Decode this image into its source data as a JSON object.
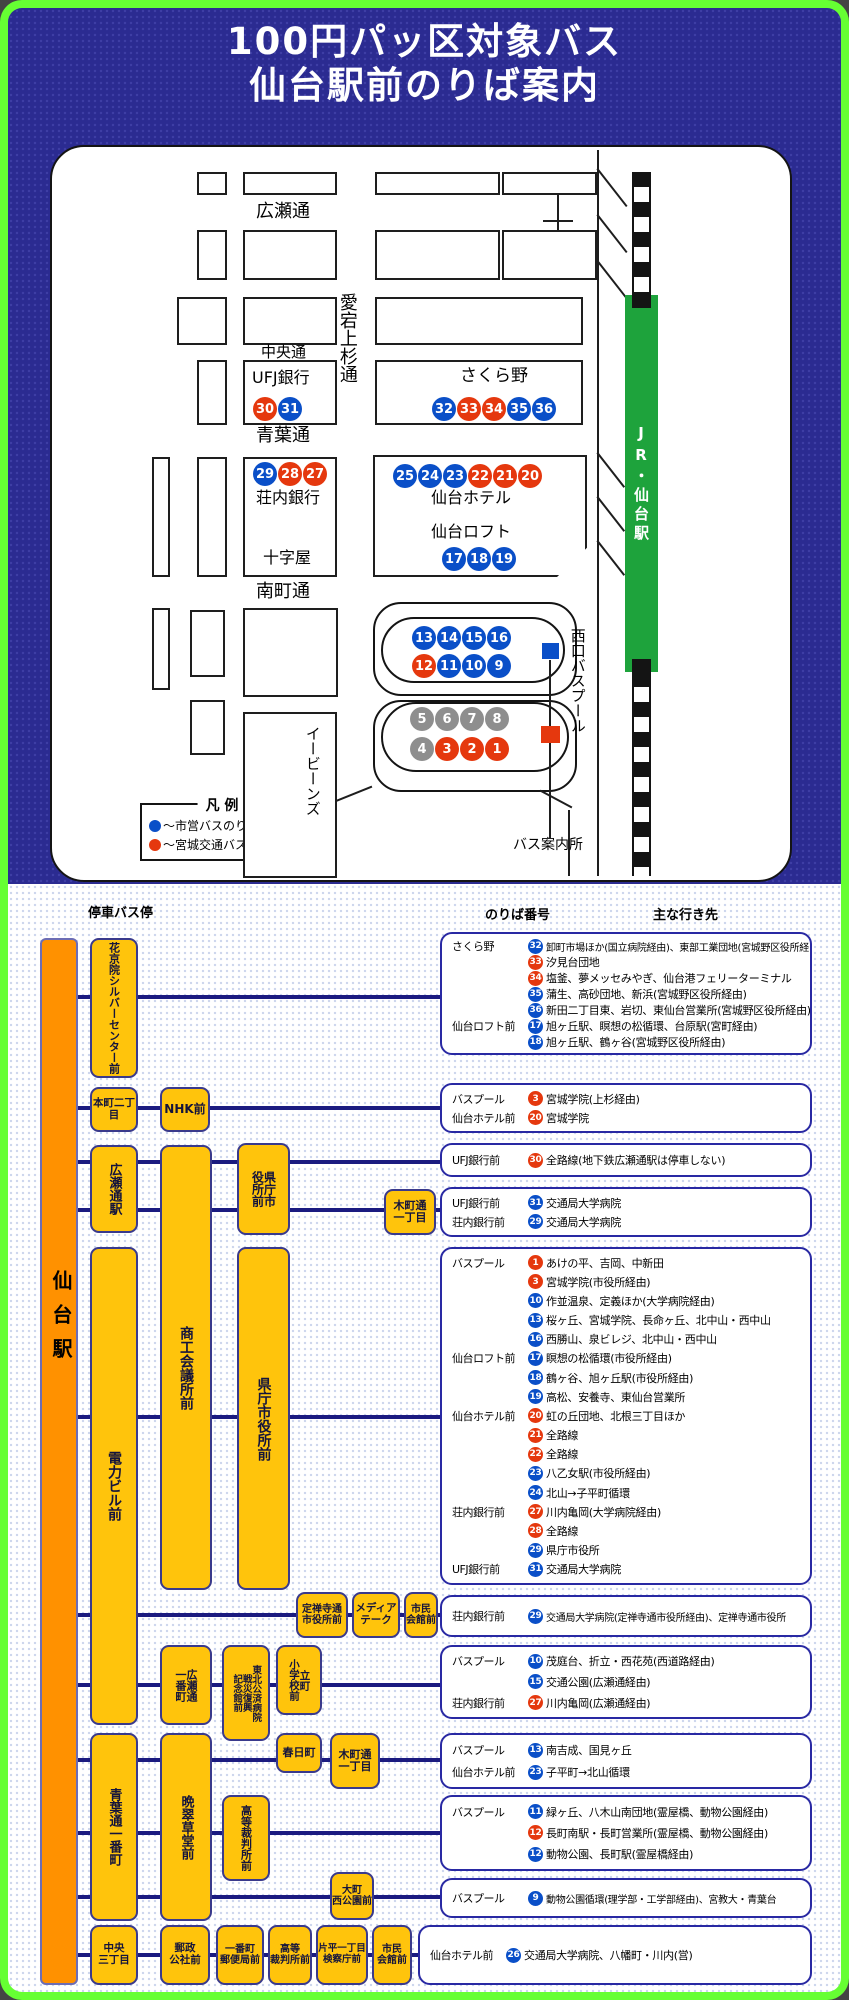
{
  "title": {
    "line1": "100円パッ区対象バス",
    "line2": "仙台駅前のりば案内"
  },
  "colors": {
    "municipal_blue": "#0a4fc8",
    "miyagi_kotsu_red": "#e5380e",
    "gray": "#8e8e8e",
    "line_navy": "#1b1b80",
    "stop_yellow": "#ffc40c",
    "station_orange": "#ff9100",
    "jr_green": "#1ea33c",
    "frame_green": "#66ff33"
  },
  "map": {
    "jr_label": "JR・仙台駅",
    "north_label": "N",
    "legend": {
      "title": "凡 例",
      "items": [
        {
          "c": "b",
          "t": "〜市営バスのりば"
        },
        {
          "c": "r",
          "t": "〜宮城交通バスのりば"
        }
      ]
    },
    "labels": [
      {
        "t": "広瀬通",
        "x": 256,
        "y": 203,
        "fs": 18
      },
      {
        "t": "中央通",
        "x": 261,
        "y": 345,
        "fs": 15
      },
      {
        "t": "青葉通",
        "x": 256,
        "y": 427,
        "fs": 18
      },
      {
        "t": "南町通",
        "x": 256,
        "y": 583,
        "fs": 18
      },
      {
        "t": "愛宕上杉通",
        "x": 337,
        "y": 293,
        "fs": 18,
        "v": 1
      },
      {
        "t": "西口バスプール",
        "x": 569,
        "y": 628,
        "fs": 15,
        "v": 1
      },
      {
        "t": "イービーンズ",
        "x": 304,
        "y": 726,
        "fs": 15,
        "v": 1
      },
      {
        "t": "バス案内所",
        "x": 513,
        "y": 838,
        "fs": 14
      },
      {
        "t": "UFJ銀行",
        "x": 252,
        "y": 370,
        "fs": 16
      },
      {
        "t": "さくら野",
        "x": 460,
        "y": 368,
        "fs": 17
      },
      {
        "t": "荘内銀行",
        "x": 256,
        "y": 490,
        "fs": 16
      },
      {
        "t": "十字屋",
        "x": 263,
        "y": 550,
        "fs": 16
      },
      {
        "t": "仙台ホテル",
        "x": 431,
        "y": 490,
        "fs": 16
      },
      {
        "t": "仙台ロフト",
        "x": 431,
        "y": 524,
        "fs": 16
      }
    ],
    "stands": [
      {
        "n": 30,
        "c": "r",
        "x": 253,
        "y": 397
      },
      {
        "n": 31,
        "c": "b",
        "x": 278,
        "y": 397
      },
      {
        "n": 32,
        "c": "b",
        "x": 432,
        "y": 397
      },
      {
        "n": 33,
        "c": "r",
        "x": 457,
        "y": 397
      },
      {
        "n": 34,
        "c": "r",
        "x": 482,
        "y": 397
      },
      {
        "n": 35,
        "c": "b",
        "x": 507,
        "y": 397
      },
      {
        "n": 36,
        "c": "b",
        "x": 532,
        "y": 397
      },
      {
        "n": 29,
        "c": "b",
        "x": 253,
        "y": 462
      },
      {
        "n": 28,
        "c": "r",
        "x": 278,
        "y": 462
      },
      {
        "n": 27,
        "c": "r",
        "x": 303,
        "y": 462
      },
      {
        "n": 25,
        "c": "b",
        "x": 393,
        "y": 464
      },
      {
        "n": 24,
        "c": "b",
        "x": 418,
        "y": 464
      },
      {
        "n": 23,
        "c": "b",
        "x": 443,
        "y": 464
      },
      {
        "n": 22,
        "c": "r",
        "x": 468,
        "y": 464
      },
      {
        "n": 21,
        "c": "r",
        "x": 493,
        "y": 464
      },
      {
        "n": 20,
        "c": "r",
        "x": 518,
        "y": 464
      },
      {
        "n": 17,
        "c": "b",
        "x": 442,
        "y": 547
      },
      {
        "n": 18,
        "c": "b",
        "x": 467,
        "y": 547
      },
      {
        "n": 19,
        "c": "b",
        "x": 492,
        "y": 547
      },
      {
        "n": 13,
        "c": "b",
        "x": 412,
        "y": 626
      },
      {
        "n": 14,
        "c": "b",
        "x": 437,
        "y": 626
      },
      {
        "n": 15,
        "c": "b",
        "x": 462,
        "y": 626
      },
      {
        "n": 16,
        "c": "b",
        "x": 487,
        "y": 626
      },
      {
        "n": 12,
        "c": "r",
        "x": 412,
        "y": 654
      },
      {
        "n": 11,
        "c": "b",
        "x": 437,
        "y": 654
      },
      {
        "n": 10,
        "c": "b",
        "x": 462,
        "y": 654
      },
      {
        "n": 9,
        "c": "b",
        "x": 487,
        "y": 654
      },
      {
        "n": 5,
        "c": "g",
        "x": 410,
        "y": 707
      },
      {
        "n": 6,
        "c": "g",
        "x": 435,
        "y": 707
      },
      {
        "n": 7,
        "c": "g",
        "x": 460,
        "y": 707
      },
      {
        "n": 8,
        "c": "g",
        "x": 485,
        "y": 707
      },
      {
        "n": 4,
        "c": "g",
        "x": 410,
        "y": 737
      },
      {
        "n": 3,
        "c": "r",
        "x": 435,
        "y": 737
      },
      {
        "n": 2,
        "c": "r",
        "x": 460,
        "y": 737
      },
      {
        "n": 1,
        "c": "r",
        "x": 485,
        "y": 737
      }
    ]
  },
  "diagram": {
    "headers": [
      "停車バス停",
      "のりば番号",
      "主な行き先"
    ],
    "station": "仙台駅",
    "stops": [
      {
        "label": "花京院シルバーセンター前",
        "x": 90,
        "y": 938,
        "w": 48,
        "h": 140,
        "mode": "v",
        "fs": 11
      },
      {
        "label": "本町二丁目",
        "x": 90,
        "y": 1087,
        "w": 48,
        "h": 45,
        "mode": "h",
        "fs": 10.5
      },
      {
        "label": "NHK前",
        "x": 160,
        "y": 1087,
        "w": 50,
        "h": 45,
        "mode": "h",
        "fs": 12
      },
      {
        "label": "広瀬通駅",
        "x": 90,
        "y": 1145,
        "w": 48,
        "h": 88,
        "mode": "v",
        "fs": 13
      },
      {
        "label": "商工会議所前",
        "x": 160,
        "y": 1145,
        "w": 52,
        "h": 445,
        "mode": "v",
        "fs": 14
      },
      {
        "label": "県庁市役所前",
        "x": 237,
        "y": 1143,
        "w": 53,
        "h": 92,
        "mode": "v",
        "lines": [
          "県庁市",
          "役所前"
        ],
        "fs": 12
      },
      {
        "label": "木町通一丁目",
        "x": 384,
        "y": 1189,
        "w": 52,
        "h": 46,
        "mode": "h",
        "lines": [
          "木町通",
          "一丁目"
        ],
        "fs": 11
      },
      {
        "label": "電力ビル前",
        "x": 90,
        "y": 1247,
        "w": 48,
        "h": 478,
        "mode": "v",
        "fs": 14
      },
      {
        "label": "県庁市役所前",
        "x": 237,
        "y": 1247,
        "w": 53,
        "h": 343,
        "mode": "v",
        "fs": 14
      },
      {
        "label": "定禅寺通市役所前",
        "x": 296,
        "y": 1592,
        "w": 52,
        "h": 46,
        "mode": "h",
        "lines": [
          "定禅寺通",
          "市役所前"
        ],
        "fs": 10
      },
      {
        "label": "メディアテーク",
        "x": 352,
        "y": 1592,
        "w": 48,
        "h": 46,
        "mode": "h",
        "lines": [
          "メディア",
          "テーク"
        ],
        "fs": 10.5
      },
      {
        "label": "市民会館前",
        "x": 404,
        "y": 1592,
        "w": 34,
        "h": 46,
        "mode": "h",
        "lines": [
          "市民",
          "会館前"
        ],
        "fs": 10
      },
      {
        "label": "広瀬通一番町",
        "x": 160,
        "y": 1645,
        "w": 52,
        "h": 80,
        "mode": "v",
        "lines": [
          "広瀬通",
          "一番町"
        ],
        "fs": 11
      },
      {
        "label": "東北公済病院戦災復興記念館前",
        "x": 222,
        "y": 1645,
        "w": 48,
        "h": 96,
        "mode": "v",
        "lines": [
          "東北公済病院",
          "戦災復興",
          "記念館前"
        ],
        "fs": 9.5
      },
      {
        "label": "立町小学校前",
        "x": 276,
        "y": 1645,
        "w": 46,
        "h": 70,
        "mode": "v",
        "lines": [
          "立町",
          "小学校前"
        ],
        "fs": 10.5
      },
      {
        "label": "青葉通一番町",
        "x": 90,
        "y": 1733,
        "w": 48,
        "h": 188,
        "mode": "v",
        "fs": 13
      },
      {
        "label": "晩翠草堂前",
        "x": 160,
        "y": 1733,
        "w": 52,
        "h": 188,
        "mode": "v",
        "fs": 13
      },
      {
        "label": "春日町",
        "x": 276,
        "y": 1733,
        "w": 46,
        "h": 40,
        "mode": "h",
        "fs": 11
      },
      {
        "label": "木町通一丁目",
        "x": 330,
        "y": 1733,
        "w": 50,
        "h": 56,
        "mode": "h",
        "lines": [
          "木町通",
          "一丁目"
        ],
        "fs": 11
      },
      {
        "label": "高等裁判所前",
        "x": 222,
        "y": 1795,
        "w": 48,
        "h": 86,
        "mode": "v",
        "fs": 11
      },
      {
        "label": "大町西公園前",
        "x": 330,
        "y": 1872,
        "w": 44,
        "h": 48,
        "mode": "h",
        "lines": [
          "大町",
          "西公園前"
        ],
        "fs": 10
      },
      {
        "label": "中央三丁目",
        "x": 90,
        "y": 1925,
        "w": 48,
        "h": 60,
        "mode": "h",
        "lines": [
          "中央",
          "三丁目"
        ],
        "fs": 10.5
      },
      {
        "label": "郵政公社前",
        "x": 160,
        "y": 1925,
        "w": 50,
        "h": 60,
        "mode": "h",
        "lines": [
          "郵政",
          "公社前"
        ],
        "fs": 10.5
      },
      {
        "label": "一番町郵便局前",
        "x": 216,
        "y": 1925,
        "w": 48,
        "h": 60,
        "mode": "h",
        "lines": [
          "一番町",
          "郵便局前"
        ],
        "fs": 10
      },
      {
        "label": "高等裁判所前",
        "x": 268,
        "y": 1925,
        "w": 44,
        "h": 60,
        "mode": "h",
        "lines": [
          "高等",
          "裁判所前"
        ],
        "fs": 10
      },
      {
        "label": "片平一丁目検察庁前",
        "x": 316,
        "y": 1925,
        "w": 52,
        "h": 60,
        "mode": "h",
        "lines": [
          "片平一丁目",
          "検察庁前"
        ],
        "fs": 9.5
      },
      {
        "label": "市民会館前",
        "x": 372,
        "y": 1925,
        "w": 40,
        "h": 60,
        "mode": "h",
        "lines": [
          "市民",
          "会館前"
        ],
        "fs": 10
      }
    ],
    "info_boxes": [
      {
        "x": 440,
        "y": 932,
        "w": 372,
        "h": 123,
        "rows": [
          {
            "s": "さくら野",
            "n": 32,
            "c": "b",
            "t": "卸町市場ほか(国立病院経由)、東部工業団地(宮城野区役所経由)",
            "small": 1
          },
          {
            "n": 33,
            "c": "r",
            "t": "汐見台団地"
          },
          {
            "n": 34,
            "c": "r",
            "t": "塩釜、夢メッセみやぎ、仙台港フェリーターミナル"
          },
          {
            "n": 35,
            "c": "b",
            "t": "蒲生、高砂団地、新浜(宮城野区役所経由)"
          },
          {
            "n": 36,
            "c": "b",
            "t": "新田二丁目東、岩切、東仙台営業所(宮城野区役所経由)"
          },
          {
            "s": "仙台ロフト前",
            "n": 17,
            "c": "b",
            "t": "旭ヶ丘駅、瞑想の松循環、台原駅(宮町経由)"
          },
          {
            "n": 18,
            "c": "b",
            "t": "旭ヶ丘駅、鶴ヶ谷(宮城野区役所経由)"
          }
        ]
      },
      {
        "x": 440,
        "y": 1083,
        "w": 372,
        "h": 50,
        "rows": [
          {
            "s": "バスプール",
            "n": 3,
            "c": "r",
            "t": "宮城学院(上杉経由)"
          },
          {
            "s": "仙台ホテル前",
            "n": 20,
            "c": "r",
            "t": "宮城学院"
          }
        ]
      },
      {
        "x": 440,
        "y": 1143,
        "w": 372,
        "h": 34,
        "rows": [
          {
            "s": "UFJ銀行前",
            "n": 30,
            "c": "r",
            "t": "全路線(地下鉄広瀬通駅は停車しない)"
          }
        ]
      },
      {
        "x": 440,
        "y": 1187,
        "w": 372,
        "h": 50,
        "rows": [
          {
            "s": "UFJ銀行前",
            "n": 31,
            "c": "b",
            "t": "交通局大学病院"
          },
          {
            "s": "荘内銀行前",
            "n": 29,
            "c": "b",
            "t": "交通局大学病院"
          }
        ]
      },
      {
        "x": 440,
        "y": 1247,
        "w": 372,
        "h": 338,
        "rows": [
          {
            "s": "バスプール",
            "n": 1,
            "c": "r",
            "t": "あけの平、吉岡、中新田"
          },
          {
            "n": 3,
            "c": "r",
            "t": "宮城学院(市役所経由)"
          },
          {
            "n": 10,
            "c": "b",
            "t": "作並温泉、定義ほか(大学病院経由)"
          },
          {
            "n": 13,
            "c": "b",
            "t": "桜ヶ丘、宮城学院、長命ヶ丘、北中山・西中山"
          },
          {
            "n": 16,
            "c": "b",
            "t": "西勝山、泉ビレジ、北中山・西中山"
          },
          {
            "s": "仙台ロフト前",
            "n": 17,
            "c": "b",
            "t": "瞑想の松循環(市役所経由)"
          },
          {
            "n": 18,
            "c": "b",
            "t": "鶴ヶ谷、旭ヶ丘駅(市役所経由)"
          },
          {
            "n": 19,
            "c": "b",
            "t": "高松、安養寺、東仙台営業所"
          },
          {
            "s": "仙台ホテル前",
            "n": 20,
            "c": "r",
            "t": "虹の丘団地、北根三丁目ほか"
          },
          {
            "n": 21,
            "c": "r",
            "t": "全路線"
          },
          {
            "n": 22,
            "c": "r",
            "t": "全路線"
          },
          {
            "n": 23,
            "c": "b",
            "t": "八乙女駅(市役所経由)"
          },
          {
            "n": 24,
            "c": "b",
            "t": "北山→子平町循環"
          },
          {
            "s": "荘内銀行前",
            "n": 27,
            "c": "r",
            "t": "川内亀岡(大学病院経由)"
          },
          {
            "n": 28,
            "c": "r",
            "t": "全路線"
          },
          {
            "n": 29,
            "c": "b",
            "t": "県庁市役所"
          },
          {
            "s": "UFJ銀行前",
            "n": 31,
            "c": "b",
            "t": "交通局大学病院"
          }
        ]
      },
      {
        "x": 440,
        "y": 1595,
        "w": 372,
        "h": 42,
        "rows": [
          {
            "s": "荘内銀行前",
            "n": 29,
            "c": "b",
            "t": "交通局大学病院(定禅寺通市役所経由)、定禅寺通市役所",
            "small": 1
          }
        ]
      },
      {
        "x": 440,
        "y": 1645,
        "w": 372,
        "h": 74,
        "rows": [
          {
            "s": "バスプール",
            "n": 10,
            "c": "b",
            "t": "茂庭台、折立・西花苑(西道路経由)"
          },
          {
            "n": 15,
            "c": "b",
            "t": "交通公園(広瀬通経由)"
          },
          {
            "s": "荘内銀行前",
            "n": 27,
            "c": "r",
            "t": "川内亀岡(広瀬通経由)"
          }
        ]
      },
      {
        "x": 440,
        "y": 1733,
        "w": 372,
        "h": 56,
        "rows": [
          {
            "s": "バスプール",
            "n": 13,
            "c": "b",
            "t": "南吉成、国見ヶ丘"
          },
          {
            "s": "仙台ホテル前",
            "n": 23,
            "c": "b",
            "t": "子平町→北山循環"
          }
        ]
      },
      {
        "x": 440,
        "y": 1795,
        "w": 372,
        "h": 76,
        "rows": [
          {
            "s": "バスプール",
            "n": 11,
            "c": "b",
            "t": "緑ヶ丘、八木山南団地(霊屋橋、動物公園経由)"
          },
          {
            "n": 12,
            "c": "r",
            "t": "長町南駅・長町営業所(霊屋橋、動物公園経由)"
          },
          {
            "n": 12,
            "c": "b",
            "t": "動物公園、長町駅(霊屋橋経由)"
          }
        ]
      },
      {
        "x": 440,
        "y": 1878,
        "w": 372,
        "h": 40,
        "rows": [
          {
            "s": "バスプール",
            "n": 9,
            "c": "b",
            "t": "動物公園循環(理学部・工学部経由)、宮教大・青葉台",
            "small": 1
          }
        ]
      },
      {
        "x": 418,
        "y": 1925,
        "w": 394,
        "h": 60,
        "rows": [
          {
            "s": "仙台ホテル前",
            "n": 26,
            "c": "b",
            "t": "交通局大学病院、八幡町・川内(営)"
          }
        ]
      }
    ]
  }
}
